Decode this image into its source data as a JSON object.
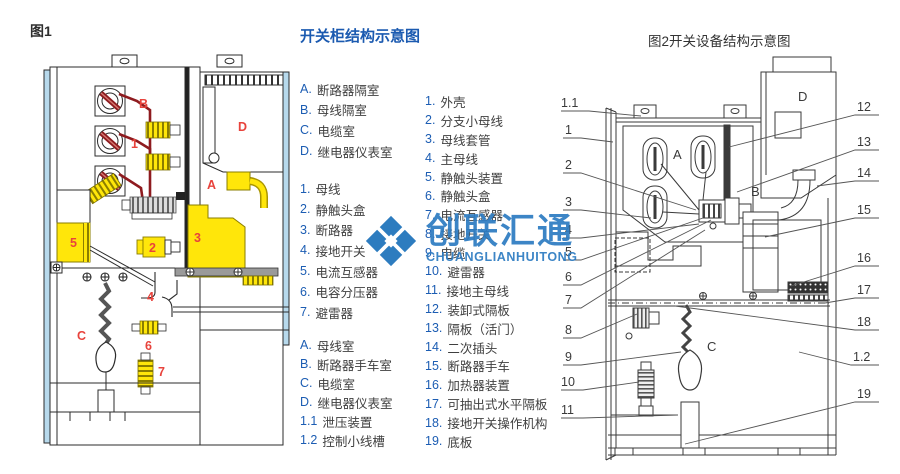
{
  "fig1": {
    "caption": "图1",
    "labels": {
      "B": "B",
      "D": "D",
      "n1": "1",
      "A": "A",
      "n5": "5",
      "n2": "2",
      "n3": "3",
      "n4": "4",
      "C": "C",
      "n6": "6",
      "n7": "7"
    }
  },
  "legend": {
    "title": "开关柜结构示意图",
    "col1": {
      "rooms1": [
        {
          "m": "A.",
          "t": "断路器隔室"
        },
        {
          "m": "B.",
          "t": "母线隔室"
        },
        {
          "m": "C.",
          "t": "电缆室"
        },
        {
          "m": "D.",
          "t": "继电器仪表室"
        }
      ],
      "parts1": [
        {
          "m": "1.",
          "t": "母线"
        },
        {
          "m": "2.",
          "t": "静触头盒"
        },
        {
          "m": "3.",
          "t": "断路器"
        },
        {
          "m": "4.",
          "t": "接地开关"
        },
        {
          "m": "5.",
          "t": "电流互感器"
        },
        {
          "m": "6.",
          "t": "电容分压器"
        },
        {
          "m": "7.",
          "t": "避雷器"
        }
      ],
      "rooms2": [
        {
          "m": "A.",
          "t": "母线室"
        },
        {
          "m": "B.",
          "t": "断路器手车室"
        },
        {
          "m": "C.",
          "t": "电缆室"
        },
        {
          "m": "D.",
          "t": "继电器仪表室"
        },
        {
          "m": "1.1",
          "t": "泄压装置"
        },
        {
          "m": "1.2",
          "t": "控制小线槽"
        }
      ]
    },
    "col2": [
      {
        "m": "1.",
        "t": "外壳"
      },
      {
        "m": "2.",
        "t": "分支小母线"
      },
      {
        "m": "3.",
        "t": "母线套管"
      },
      {
        "m": "4.",
        "t": "主母线"
      },
      {
        "m": "5.",
        "t": "静触头装置"
      },
      {
        "m": "6.",
        "t": "静触头盒"
      },
      {
        "m": "7.",
        "t": "电流互感器"
      },
      {
        "m": "8.",
        "t": "接地开关"
      },
      {
        "m": "9.",
        "t": "电缆"
      },
      {
        "m": "10.",
        "t": "避雷器"
      },
      {
        "m": "11.",
        "t": "接地主母线"
      },
      {
        "m": "12.",
        "t": "装卸式隔板"
      },
      {
        "m": "13.",
        "t": "隔板（活门）"
      },
      {
        "m": "14.",
        "t": "二次插头"
      },
      {
        "m": "15.",
        "t": "断路器手车"
      },
      {
        "m": "16.",
        "t": "加热器装置"
      },
      {
        "m": "17.",
        "t": "可抽出式水平隔板"
      },
      {
        "m": "18.",
        "t": "接地开关操作机构"
      },
      {
        "m": "19.",
        "t": "底板"
      }
    ]
  },
  "fig2": {
    "caption": "图2开关设备结构示意图",
    "left_labels": [
      "1.1",
      "1",
      "2",
      "3",
      "4",
      "5",
      "6",
      "7",
      "8",
      "9",
      "10",
      "11"
    ],
    "right_labels": [
      "12",
      "13",
      "14",
      "15",
      "16",
      "17",
      "18",
      "1.2",
      "19"
    ],
    "inner": {
      "A": "A",
      "B": "B",
      "C": "C",
      "D": "D"
    }
  },
  "watermark": {
    "text": "创联汇通",
    "subtext": "CHUANGLIANHUITONG"
  },
  "colors": {
    "title_blue": "#1b5ab0",
    "marker_blue": "#1c5db3",
    "label_red": "#e8433c",
    "busbar_dark_red": "#8e1b1f",
    "component_yellow": "#ffe60a",
    "panel_light_blue": "#b7d9ec",
    "watermark_blue": "#2e7cc2"
  }
}
